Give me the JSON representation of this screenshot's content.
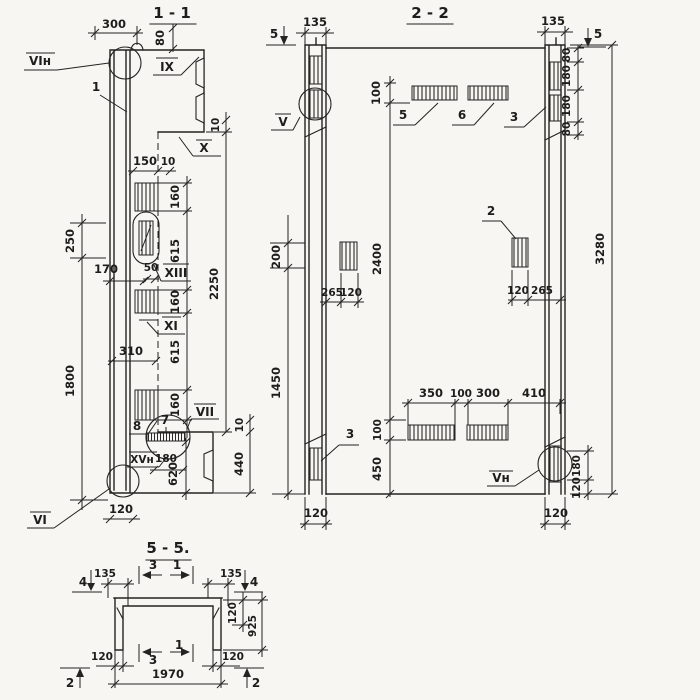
{
  "page": {
    "background": "#f7f6f2",
    "ink": "#232321"
  },
  "s11": {
    "title": "1 - 1",
    "callouts": {
      "vi_top": "VIн",
      "pos1": "1",
      "ix": "IX",
      "x": "X",
      "xiii": "XIII",
      "xi": "XI",
      "pos8": "8",
      "pos7": "7",
      "vii": "VII",
      "xv": "XVн",
      "vi_bot": "VI"
    },
    "dims": {
      "w300": "300",
      "h80": "80",
      "w150": "150",
      "w10": "10",
      "h10_top": "10",
      "s160a": "160",
      "s615a": "615",
      "s160b": "160",
      "s615b": "615",
      "s160c": "160",
      "h2250": "2250",
      "h250": "250",
      "w170": "170",
      "w50": "50",
      "w310": "310",
      "h1800": "1800",
      "h10_bot": "10",
      "h440": "440",
      "h620": "620",
      "w180": "180",
      "w120": "120"
    }
  },
  "s22": {
    "title": "2 - 2",
    "callouts": {
      "v": "V",
      "vn": "Vн",
      "pos2": "2",
      "pos3_top": "3",
      "pos3_bot": "3",
      "pos5": "5",
      "pos6": "6"
    },
    "markers": {
      "m5_left": "5",
      "m5_right": "5"
    },
    "dims": {
      "w135_left": "135",
      "w135_right": "135",
      "h100_top": "100",
      "h80a": "80",
      "h180a": "180",
      "h180b": "180",
      "h80b": "80",
      "h200": "200",
      "h2400": "2400",
      "w265_left": "265",
      "w120_left": "120",
      "w120_right": "120",
      "w265_right": "265",
      "h3280": "3280",
      "h1450": "1450",
      "w350": "350",
      "w100": "100",
      "w300": "300",
      "w410": "410",
      "h100_bot": "100",
      "h450": "450",
      "h180_right": "180",
      "h120_right": "120",
      "w120_bot_left": "120",
      "w120_bot_right": "120"
    }
  },
  "s55": {
    "title": "5 - 5.",
    "markers": {
      "m4_left": "4",
      "m4_right": "4",
      "m2_left": "2",
      "m2_right": "2",
      "c3_top": "3",
      "c1_top": "1",
      "c3_bot": "3",
      "c1_bot": "1"
    },
    "dims": {
      "w135_left": "135",
      "w135_right": "135",
      "h120_flange": "120",
      "h925": "925",
      "w120_left": "120",
      "w120_right": "120",
      "w1970": "1970"
    }
  }
}
